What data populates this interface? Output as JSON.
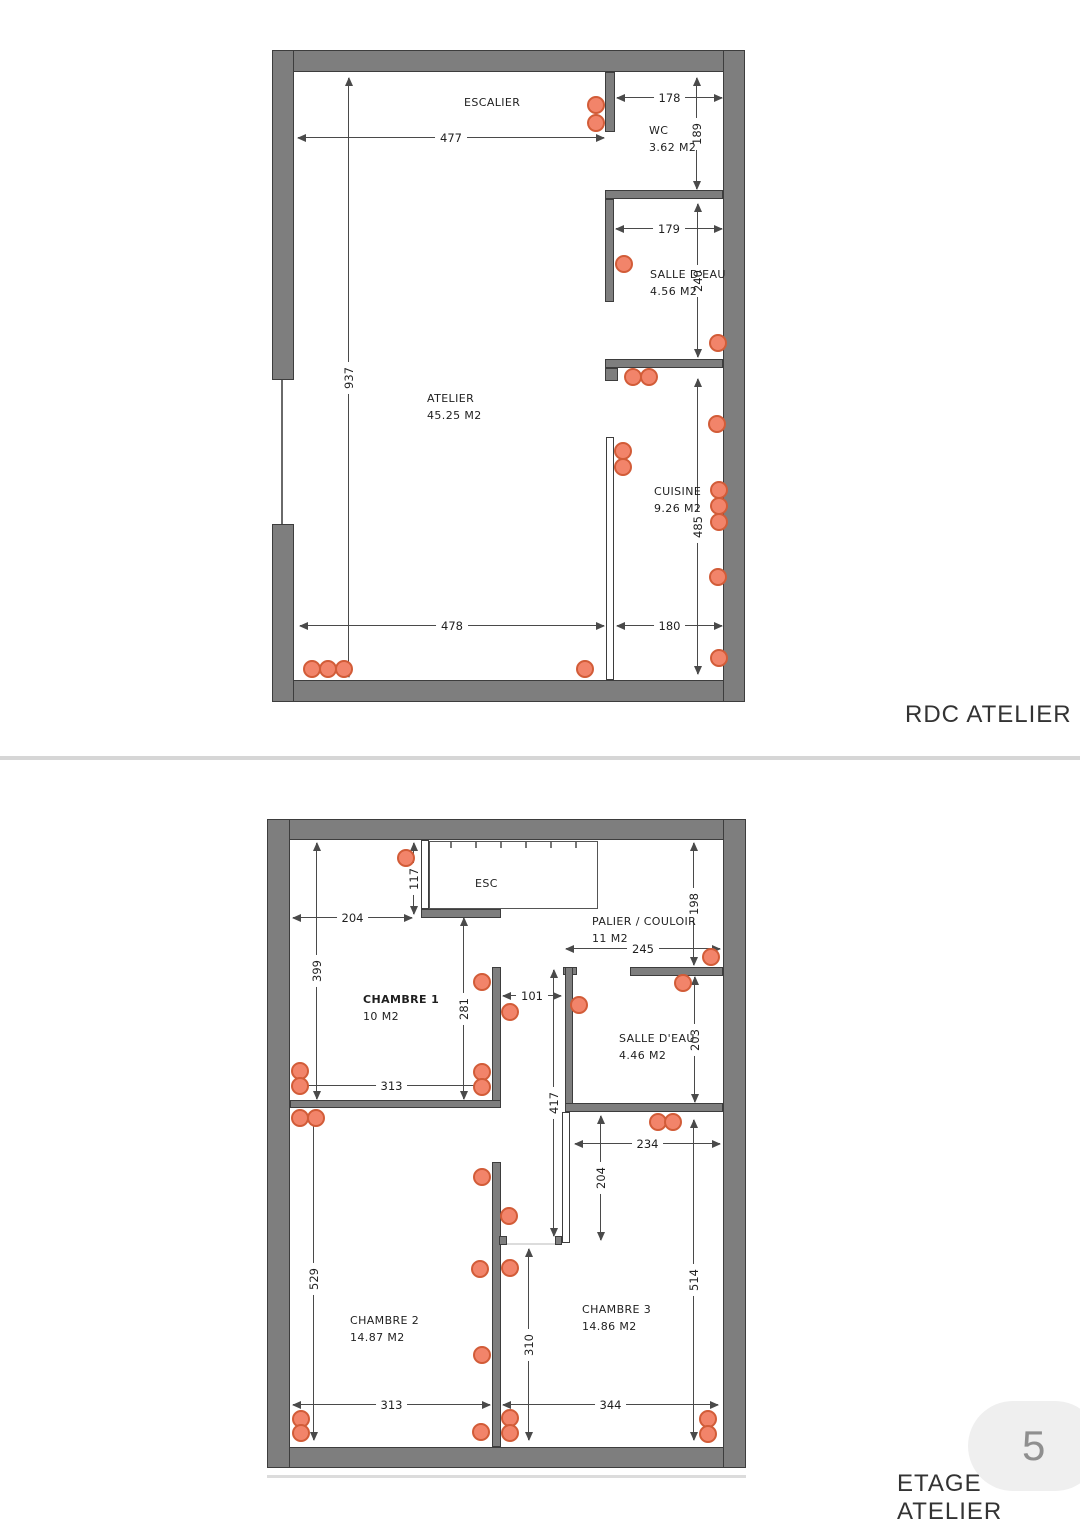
{
  "page": {
    "plan1_title": "RDC ATELIER",
    "plan2_title": "ETAGE ATELIER",
    "page_badge": {
      "number": "5"
    }
  },
  "style": {
    "wall_fill": "#7e7e7e",
    "wall_stroke": "#3d3d3d",
    "dot_fill": "#f2846a",
    "dot_stroke": "#d25c38",
    "dim_color": "#4a4a4a",
    "text_color": "#1f1f1f",
    "title_color": "#333333",
    "divider_color": "#d6d6d6",
    "badge_bg": "#efefef",
    "badge_text": "#8f8f8f"
  },
  "plans": [
    {
      "id": "rdc",
      "walls": [
        {
          "x": 272,
          "y": 50,
          "w": 473,
          "h": 22,
          "k": "solid",
          "n": "outer-wall-top"
        },
        {
          "x": 272,
          "y": 680,
          "w": 473,
          "h": 22,
          "k": "solid",
          "n": "outer-wall-bottom"
        },
        {
          "x": 723,
          "y": 50,
          "w": 22,
          "h": 652,
          "k": "solid",
          "n": "outer-wall-right"
        },
        {
          "x": 272,
          "y": 50,
          "w": 22,
          "h": 330,
          "k": "solid",
          "n": "outer-wall-left-upper"
        },
        {
          "x": 272,
          "y": 524,
          "w": 22,
          "h": 178,
          "k": "solid",
          "n": "outer-wall-left-lower"
        },
        {
          "x": 281,
          "y": 380,
          "w": 2,
          "h": 144,
          "k": "line",
          "n": "window-line"
        },
        {
          "x": 605,
          "y": 72,
          "w": 10,
          "h": 60,
          "k": "solid",
          "n": "wall-wc-left"
        },
        {
          "x": 605,
          "y": 190,
          "w": 118,
          "h": 9,
          "k": "solid",
          "n": "wall-wc-bottom"
        },
        {
          "x": 605,
          "y": 199,
          "w": 9,
          "h": 103,
          "k": "solid",
          "n": "wall-salle-deau-left"
        },
        {
          "x": 605,
          "y": 359,
          "w": 118,
          "h": 9,
          "k": "solid",
          "n": "wall-salle-deau-bottom"
        },
        {
          "x": 605,
          "y": 368,
          "w": 13,
          "h": 13,
          "k": "solid",
          "n": "wall-stub"
        },
        {
          "x": 606,
          "y": 437,
          "w": 8,
          "h": 243,
          "k": "thin",
          "n": "wall-cuisine-partition"
        }
      ],
      "dims": [
        {
          "v": "477",
          "o": "h",
          "a": 298,
          "b": 604,
          "p": 137
        },
        {
          "v": "178",
          "o": "h",
          "a": 617,
          "b": 722,
          "p": 97
        },
        {
          "v": "189",
          "o": "v",
          "a": 78,
          "b": 189,
          "p": 696
        },
        {
          "v": "179",
          "o": "h",
          "a": 616,
          "b": 722,
          "p": 228
        },
        {
          "v": "240",
          "o": "v",
          "a": 204,
          "b": 357,
          "p": 697
        },
        {
          "v": "937",
          "o": "v",
          "a": 78,
          "b": 677,
          "p": 348
        },
        {
          "v": "485",
          "o": "v",
          "a": 379,
          "b": 674,
          "p": 697
        },
        {
          "v": "478",
          "o": "h",
          "a": 300,
          "b": 604,
          "p": 625
        },
        {
          "v": "180",
          "o": "h",
          "a": 617,
          "b": 722,
          "p": 625
        }
      ],
      "rooms": [
        {
          "t": [
            "ESCALIER"
          ],
          "x": 464,
          "y": 94
        },
        {
          "t": [
            "WC",
            "3.62 M2"
          ],
          "x": 649,
          "y": 122
        },
        {
          "t": [
            "SALLE D'EAU",
            "4.56 M2"
          ],
          "x": 650,
          "y": 266
        },
        {
          "t": [
            "ATELIER",
            "45.25 M2"
          ],
          "x": 427,
          "y": 390
        },
        {
          "t": [
            "CUISINE",
            "9.26 M2"
          ],
          "x": 654,
          "y": 483
        }
      ],
      "dots": [
        [
          596,
          105
        ],
        [
          596,
          123
        ],
        [
          624,
          264
        ],
        [
          718,
          343
        ],
        [
          633,
          377
        ],
        [
          649,
          377
        ],
        [
          717,
          424
        ],
        [
          623,
          451
        ],
        [
          623,
          467
        ],
        [
          719,
          490
        ],
        [
          719,
          506
        ],
        [
          719,
          522
        ],
        [
          718,
          577
        ],
        [
          719,
          658
        ],
        [
          312,
          669
        ],
        [
          328,
          669
        ],
        [
          344,
          669
        ],
        [
          585,
          669
        ]
      ]
    },
    {
      "id": "etage",
      "walls": [
        {
          "x": 267,
          "y": 819,
          "w": 479,
          "h": 21,
          "k": "solid",
          "n": "outer-wall-top"
        },
        {
          "x": 267,
          "y": 1447,
          "w": 479,
          "h": 21,
          "k": "solid",
          "n": "outer-wall-bottom"
        },
        {
          "x": 267,
          "y": 819,
          "w": 23,
          "h": 649,
          "k": "solid",
          "n": "outer-wall-left"
        },
        {
          "x": 723,
          "y": 819,
          "w": 23,
          "h": 649,
          "k": "solid",
          "n": "outer-wall-right"
        },
        {
          "x": 421,
          "y": 840,
          "w": 8,
          "h": 69,
          "k": "thin",
          "n": "wall-stair-left"
        },
        {
          "x": 429,
          "y": 841,
          "w": 169,
          "h": 68,
          "k": "stair",
          "n": "stair-outline"
        },
        {
          "x": 421,
          "y": 909,
          "w": 80,
          "h": 9,
          "k": "solid",
          "n": "wall-below-stair"
        },
        {
          "x": 492,
          "y": 967,
          "w": 9,
          "h": 141,
          "k": "solid",
          "n": "wall-chambre1-right"
        },
        {
          "x": 290,
          "y": 1100,
          "w": 211,
          "h": 8,
          "k": "solid",
          "n": "wall-chambre1-bottom"
        },
        {
          "x": 492,
          "y": 1162,
          "w": 9,
          "h": 285,
          "k": "solid",
          "n": "wall-chambre2-right"
        },
        {
          "x": 563,
          "y": 967,
          "w": 14,
          "h": 8,
          "k": "solid",
          "n": "wall-salle-deau-cap"
        },
        {
          "x": 565,
          "y": 967,
          "w": 8,
          "h": 145,
          "k": "solid",
          "n": "wall-salle-deau-left"
        },
        {
          "x": 630,
          "y": 967,
          "w": 93,
          "h": 9,
          "k": "solid",
          "n": "wall-salle-deau-top"
        },
        {
          "x": 565,
          "y": 1103,
          "w": 158,
          "h": 9,
          "k": "solid",
          "n": "wall-salle-deau-bottom"
        },
        {
          "x": 562,
          "y": 1112,
          "w": 8,
          "h": 131,
          "k": "thin",
          "n": "wall-corridor-right"
        },
        {
          "x": 499,
          "y": 1236,
          "w": 8,
          "h": 9,
          "k": "solid",
          "n": "wall-stub-left"
        },
        {
          "x": 555,
          "y": 1236,
          "w": 7,
          "h": 9,
          "k": "solid",
          "n": "wall-stub-right"
        },
        {
          "x": 500,
          "y": 1243,
          "w": 56,
          "h": 2,
          "k": "light",
          "n": "door-threshold"
        },
        {
          "x": 267,
          "y": 1475,
          "w": 479,
          "h": 3,
          "k": "light",
          "n": "plan-shadow-line"
        }
      ],
      "dims": [
        {
          "v": "117",
          "o": "v",
          "a": 843,
          "b": 914,
          "p": 413
        },
        {
          "v": "204",
          "o": "h",
          "a": 293,
          "b": 412,
          "p": 917
        },
        {
          "v": "399",
          "o": "v",
          "a": 843,
          "b": 1099,
          "p": 316
        },
        {
          "v": "281",
          "o": "v",
          "a": 918,
          "b": 1099,
          "p": 463
        },
        {
          "v": "101",
          "o": "h",
          "a": 503,
          "b": 561,
          "p": 995
        },
        {
          "v": "245",
          "o": "h",
          "a": 566,
          "b": 720,
          "p": 948
        },
        {
          "v": "198",
          "o": "v",
          "a": 843,
          "b": 965,
          "p": 693
        },
        {
          "v": "203",
          "o": "v",
          "a": 977,
          "b": 1102,
          "p": 694
        },
        {
          "v": "417",
          "o": "v",
          "a": 970,
          "b": 1236,
          "p": 553
        },
        {
          "v": "234",
          "o": "h",
          "a": 575,
          "b": 720,
          "p": 1143
        },
        {
          "v": "204",
          "o": "v",
          "a": 1116,
          "b": 1240,
          "p": 600
        },
        {
          "v": "529",
          "o": "v",
          "a": 1117,
          "b": 1440,
          "p": 313
        },
        {
          "v": "514",
          "o": "v",
          "a": 1120,
          "b": 1440,
          "p": 693
        },
        {
          "v": "310",
          "o": "v",
          "a": 1249,
          "b": 1440,
          "p": 528
        },
        {
          "v": "313",
          "o": "h",
          "a": 293,
          "b": 490,
          "p": 1085
        },
        {
          "v": "313",
          "o": "h",
          "a": 293,
          "b": 490,
          "p": 1404
        },
        {
          "v": "344",
          "o": "h",
          "a": 503,
          "b": 718,
          "p": 1404
        }
      ],
      "rooms": [
        {
          "t": [
            "ESC"
          ],
          "x": 475,
          "y": 875
        },
        {
          "t": [
            "PALIER / COULOIR",
            "11 M2"
          ],
          "x": 592,
          "y": 913
        },
        {
          "t": [
            "CHAMBRE 1",
            "10 M2"
          ],
          "x": 363,
          "y": 991,
          "bold": true
        },
        {
          "t": [
            "SALLE D'EAU",
            "4.46 M2"
          ],
          "x": 619,
          "y": 1030
        },
        {
          "t": [
            "CHAMBRE 2",
            "14.87 M2"
          ],
          "x": 350,
          "y": 1312
        },
        {
          "t": [
            "CHAMBRE 3",
            "14.86 M2"
          ],
          "x": 582,
          "y": 1301
        }
      ],
      "dots": [
        [
          406,
          858
        ],
        [
          482,
          982
        ],
        [
          510,
          1012
        ],
        [
          579,
          1005
        ],
        [
          683,
          983
        ],
        [
          711,
          957
        ],
        [
          300,
          1071
        ],
        [
          300,
          1086
        ],
        [
          482,
          1072
        ],
        [
          482,
          1087
        ],
        [
          300,
          1118
        ],
        [
          316,
          1118
        ],
        [
          658,
          1122
        ],
        [
          673,
          1122
        ],
        [
          482,
          1177
        ],
        [
          509,
          1216
        ],
        [
          480,
          1269
        ],
        [
          510,
          1268
        ],
        [
          482,
          1355
        ],
        [
          301,
          1419
        ],
        [
          301,
          1433
        ],
        [
          481,
          1432
        ],
        [
          510,
          1418
        ],
        [
          510,
          1433
        ],
        [
          708,
          1419
        ],
        [
          708,
          1434
        ]
      ]
    }
  ]
}
